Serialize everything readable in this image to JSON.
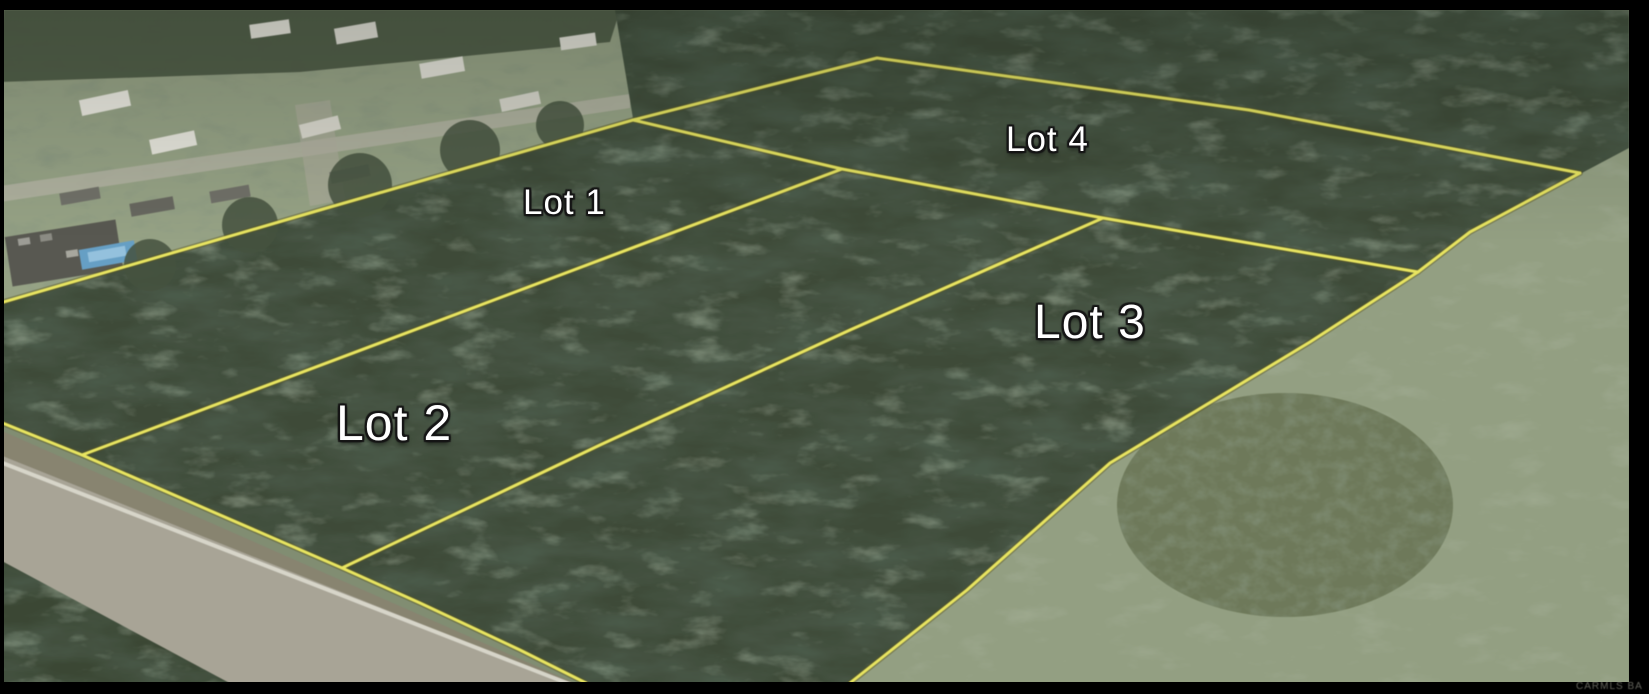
{
  "map": {
    "lots": [
      {
        "label": "Lot 1"
      },
      {
        "label": "Lot 2"
      },
      {
        "label": "Lot 3"
      },
      {
        "label": "Lot 4"
      }
    ],
    "watermark": "CARMLS BA",
    "colors": {
      "boundary_line": "#e8e44c",
      "label_text": "#ffffff",
      "forest": "#3a4733",
      "open_field": "#909d7c",
      "road": "#a6a292",
      "letterbox": "#000000"
    }
  }
}
